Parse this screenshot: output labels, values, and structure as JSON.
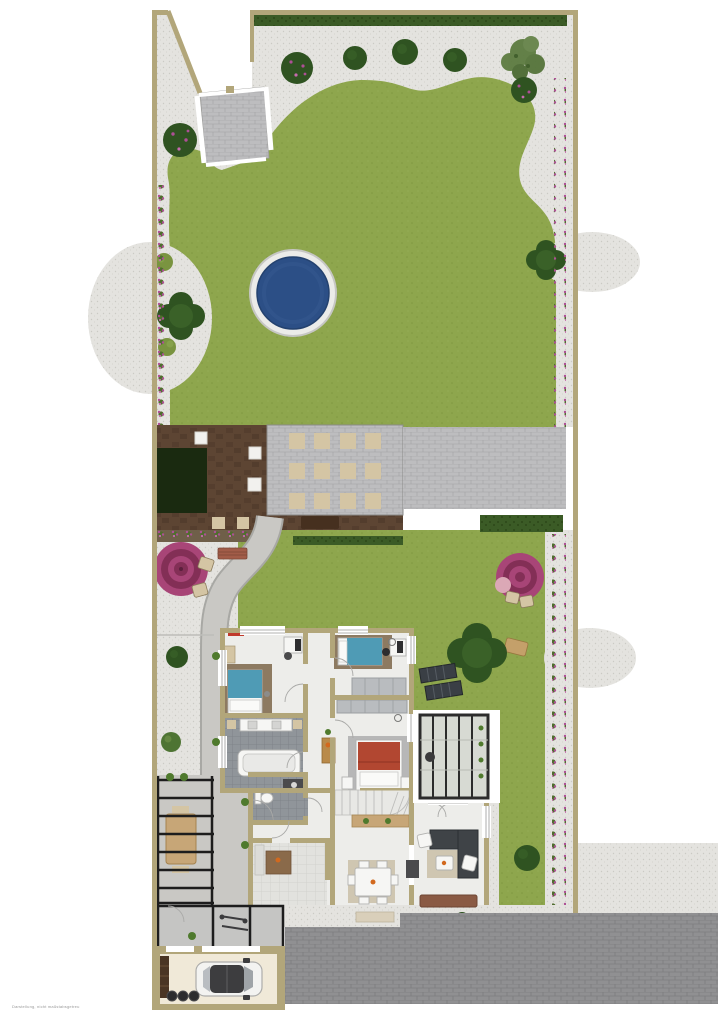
{
  "page": {
    "background": "#ffffff",
    "disclaimer": "Darstellung, nicht maßstabsgetreu"
  },
  "colors": {
    "gravel": "#e4e3df",
    "gravelDot": "#cbcac4",
    "lawn": "#8ea64d",
    "lawnDark": "#7f9740",
    "hedge": "#3b5b26",
    "hedgeDark": "#2c4719",
    "treeDark": "#2f5321",
    "treeMid": "#4e7433",
    "bushLight": "#7a9440",
    "flower": "#ae4f96",
    "wall": "#b2a67a",
    "wallDark": "#8f8560",
    "poolWater": "#2c4f86",
    "poolEdge": "#ebebe9",
    "deckBrown": "#5d4533",
    "deckDark": "#4b3628",
    "bedGreen": "#1a2a10",
    "cobble": "#bdbdbf",
    "cobbleLine": "#a9a9ab",
    "stoneBeige": "#d4c5a4",
    "path": "#c9c8c4",
    "drive": "#909092",
    "driveLine": "#7d7d7f",
    "floor": "#ededea",
    "tileDark": "#90959a",
    "tileDarkLine": "#7b8085",
    "tileLight": "#e2e2de",
    "tileLightLine": "#cfcfc9",
    "rugBrown": "#8d7a61",
    "rugGray": "#b7b7b7",
    "rugBeige": "#cfc6b1",
    "bedBlue": "#4f9bb5",
    "bedRed": "#b24731",
    "sofaDark": "#3f4347",
    "frameDark": "#2c2c2c",
    "glass": "#d7dad3",
    "wood": "#c7a677",
    "woodDark": "#8a6a4a",
    "parasolA": "#a84577",
    "parasolB": "#832f56",
    "carBody": "#f3f3f1",
    "carGlass": "#3d3d3f",
    "plantGreen": "#4f7a2d",
    "soil": "#6f5f49",
    "benchRed": "#a25c48",
    "lounger": "#3a3f45"
  },
  "plan": {
    "type": "site-and-floor-plan",
    "garden": {
      "features": [
        "perimeter gravel path",
        "organic lawn",
        "round swimming pool",
        "top boundary hedge",
        "flower borders",
        "globe trees",
        "flowering shrubs",
        "gated entrance walk",
        "wooden deck with planting bed",
        "stepping-stone patio",
        "paved terrace strip",
        "left parasol seating",
        "right parasol seating",
        "garden bench",
        "curved walkway",
        "two sun loungers",
        "lawn shrubs"
      ]
    },
    "house": {
      "rooms": [
        "bedroom top-left with desk and blue bed",
        "bedroom top-right with desk and blue bed",
        "bedroom with red double bed",
        "bathroom with tub and double basin",
        "wc with utility counter",
        "hallway with console",
        "winder staircase with sideboard",
        "kitchen with island",
        "dining room with table for six",
        "living room with corner sofa",
        "conservatory with glazed roof"
      ]
    },
    "outbuildings": [
      "pergola with outdoor dining table",
      "bike and bin storage",
      "garage with parked car",
      "cobbled driveway"
    ]
  }
}
